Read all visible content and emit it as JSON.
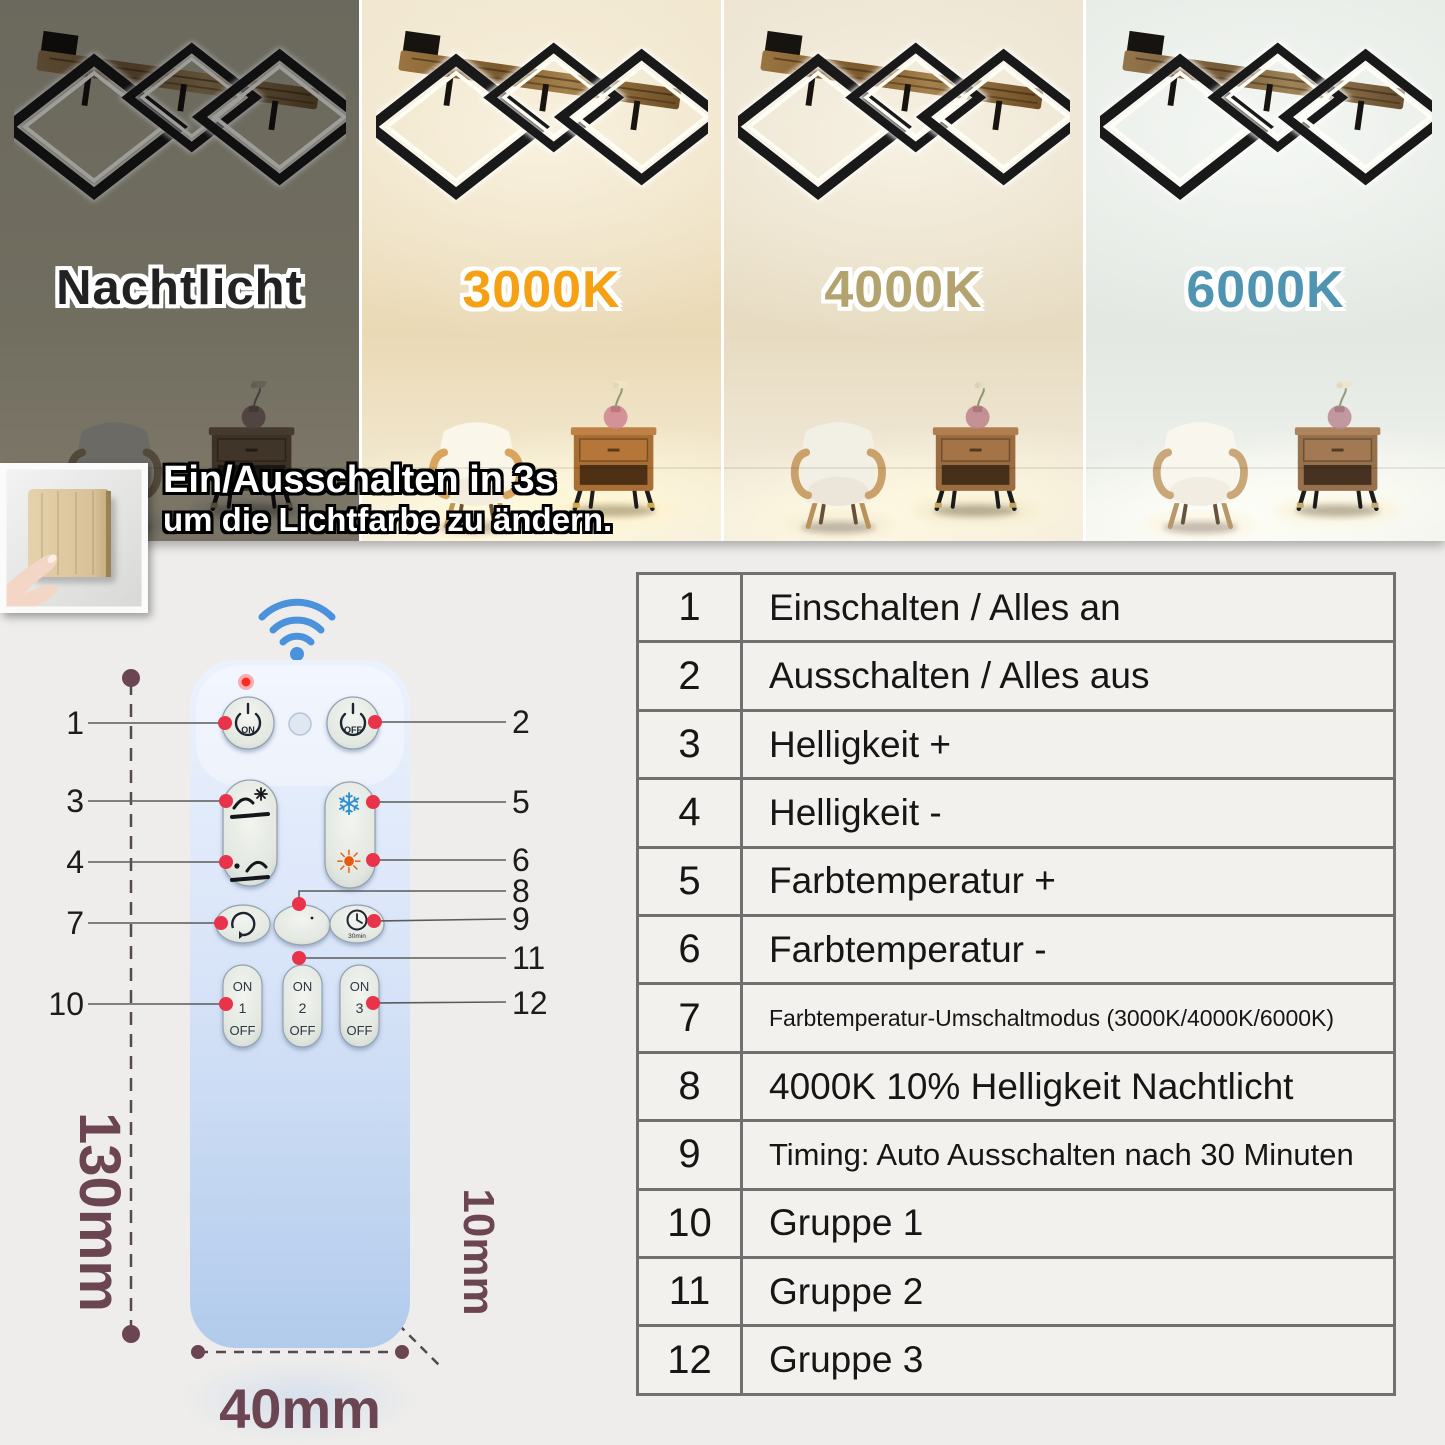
{
  "panels": [
    {
      "label": "Nachtlicht",
      "color": "#222222"
    },
    {
      "label": "3000K",
      "color": "#f5a113"
    },
    {
      "label": "4000K",
      "color": "#b3a36e"
    },
    {
      "label": "6000K",
      "color": "#4f95b2"
    }
  ],
  "banner": {
    "line1": "Ein/Ausschalten in 3s",
    "line2": "um die Lichtfarbe zu ändern."
  },
  "remote": {
    "on_label": "ON",
    "off_label": "OFF",
    "timer_caption": "30min",
    "group_buttons": [
      {
        "on": "ON",
        "num": "1",
        "off": "OFF"
      },
      {
        "on": "ON",
        "num": "2",
        "off": "OFF"
      },
      {
        "on": "ON",
        "num": "3",
        "off": "OFF"
      }
    ],
    "callouts": [
      "1",
      "2",
      "3",
      "4",
      "5",
      "6",
      "7",
      "8",
      "9",
      "10",
      "11",
      "12"
    ]
  },
  "dimensions": {
    "height": "130mm",
    "width": "40mm",
    "thickness": "10mm"
  },
  "icons": {
    "snowflake": "❄",
    "sun": "☀"
  },
  "colors": {
    "wifi_blue": "#4b92dd",
    "callout_red": "#e8334a",
    "dimension_maroon": "#6b4652",
    "snowflake_blue": "#2a8fd4",
    "sun_orange": "#e85a10",
    "led_red": "#ff2a22"
  },
  "table": {
    "rows": [
      {
        "num": "1",
        "label": "Einschalten / Alles an"
      },
      {
        "num": "2",
        "label": "Ausschalten / Alles aus"
      },
      {
        "num": "3",
        "label": "Helligkeit +"
      },
      {
        "num": "4",
        "label": "Helligkeit -"
      },
      {
        "num": "5",
        "label": "Farbtemperatur +"
      },
      {
        "num": "6",
        "label": "Farbtemperatur -"
      },
      {
        "num": "7",
        "label": "Farbtemperatur-Umschaltmodus (3000K/4000K/6000K)"
      },
      {
        "num": "8",
        "label": "4000K 10% Helligkeit Nachtlicht"
      },
      {
        "num": "9",
        "label": "Timing: Auto Ausschalten nach 30 Minuten"
      },
      {
        "num": "10",
        "label": "Gruppe 1"
      },
      {
        "num": "11",
        "label": "Gruppe 2"
      },
      {
        "num": "12",
        "label": "Gruppe 3"
      }
    ]
  }
}
